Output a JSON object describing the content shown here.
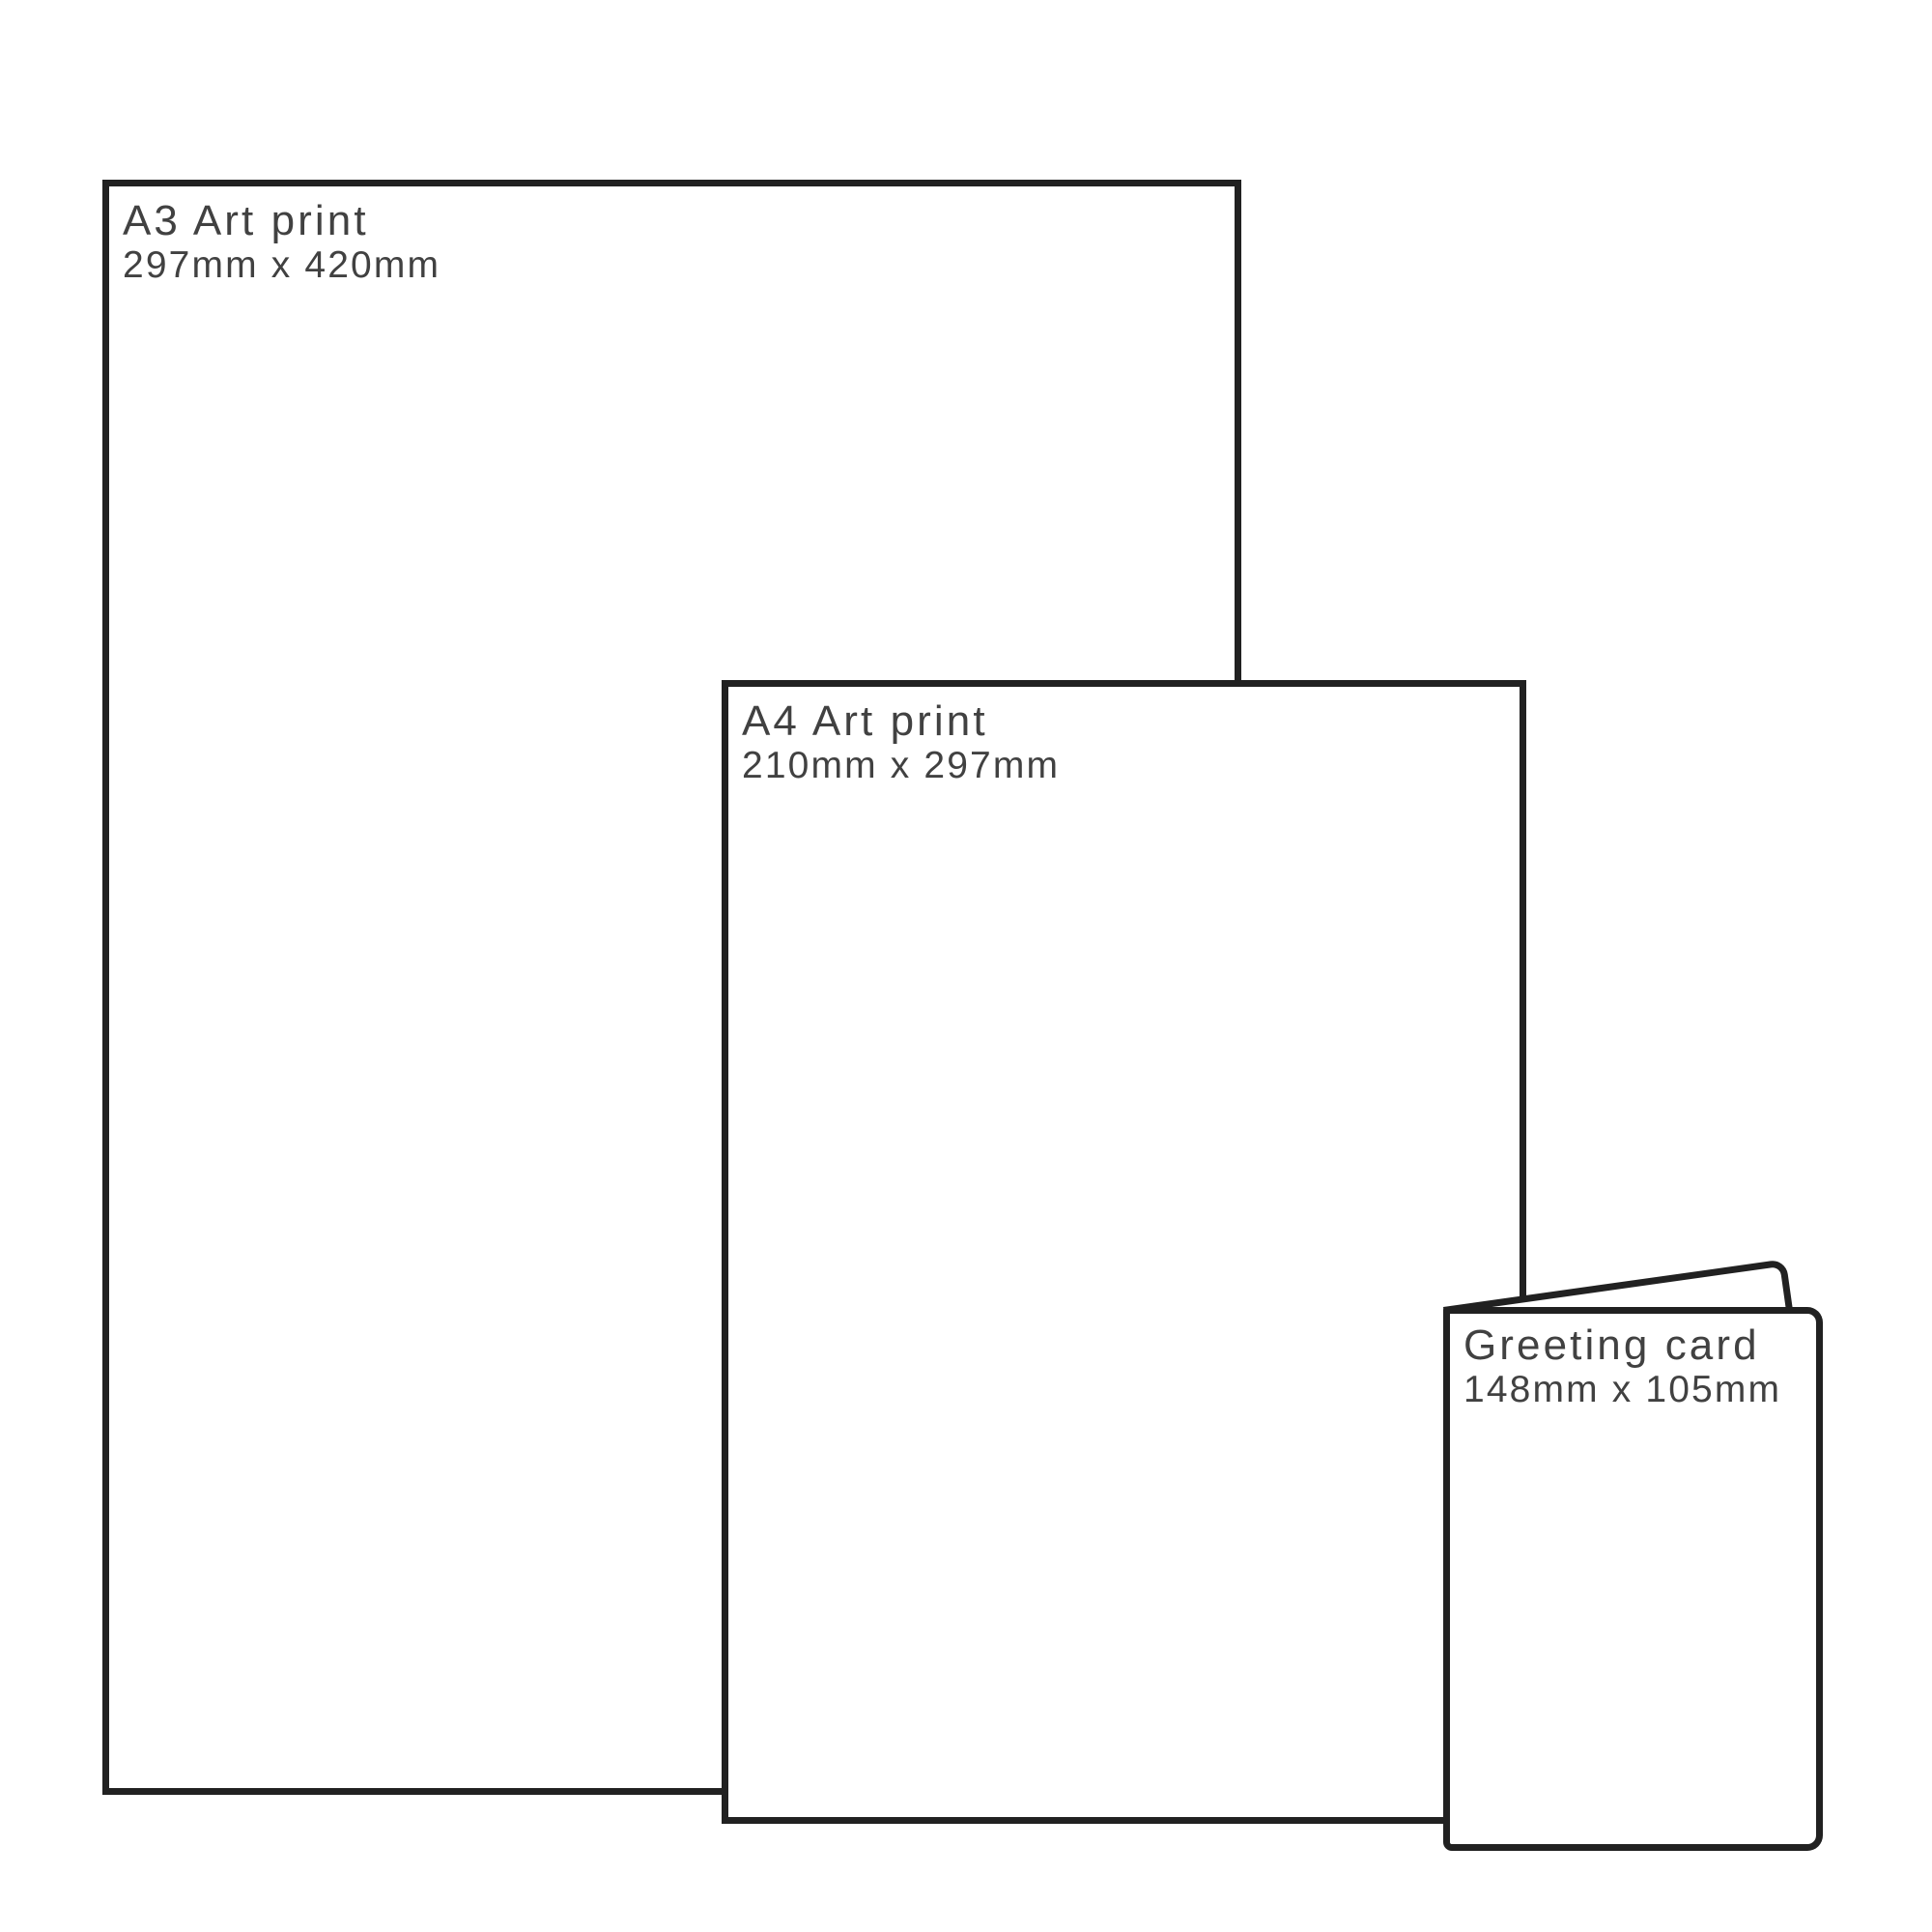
{
  "style": {
    "border_color": "#212121",
    "text_color": "#414141",
    "background_color": "#ffffff"
  },
  "items": [
    {
      "id": "a3",
      "title": "A3 Art print",
      "dimensions": "297mm x 420mm"
    },
    {
      "id": "a4",
      "title": "A4 Art print",
      "dimensions": "210mm x 297mm"
    },
    {
      "id": "card",
      "title": "Greeting card",
      "dimensions": "148mm x 105mm"
    }
  ]
}
